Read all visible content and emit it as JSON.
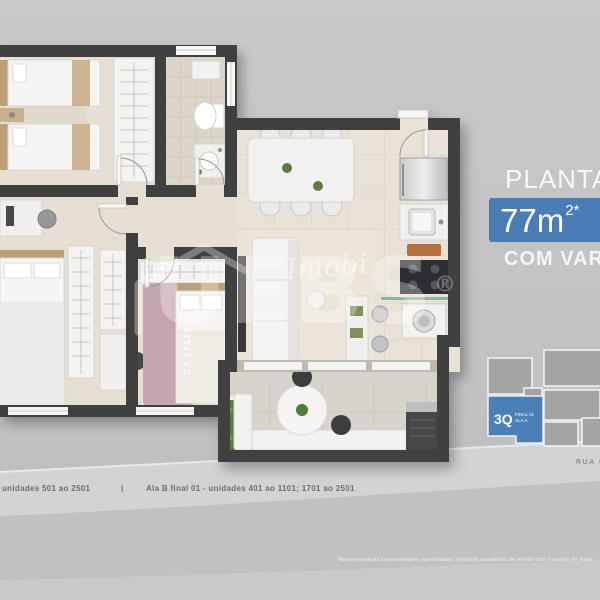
{
  "panel": {
    "title": "PLANTA",
    "area_value": "77m",
    "area_sup": "2*",
    "subtitle": "COM VAR",
    "street": "RUA C"
  },
  "keyplan": {
    "unit_primary": "3Q",
    "unit_line1": "FINAL 01",
    "unit_line2": "ALA A"
  },
  "watermarks": {
    "script": "Imobi",
    "brand": "UEBS",
    "registered": "®",
    "creci": "CJ 17870"
  },
  "footer": {
    "left": "unidades 501 ao 2501",
    "divider": "|",
    "right": "Ala B final 01 - unidades 401 ao 1101; 1701 ao 2501",
    "disclaimer": "*Áreas privativas com metragens aproximadas, incluindo esquadrias de acordo com o quadro de áreas."
  },
  "colors": {
    "accent_blue": "#4a7db5",
    "keyplan_unit_blue": "#4a80b8",
    "wall": "#3f3f41",
    "floor_beige": "#e7e1d5",
    "background_gray": "#c6c6c8"
  }
}
